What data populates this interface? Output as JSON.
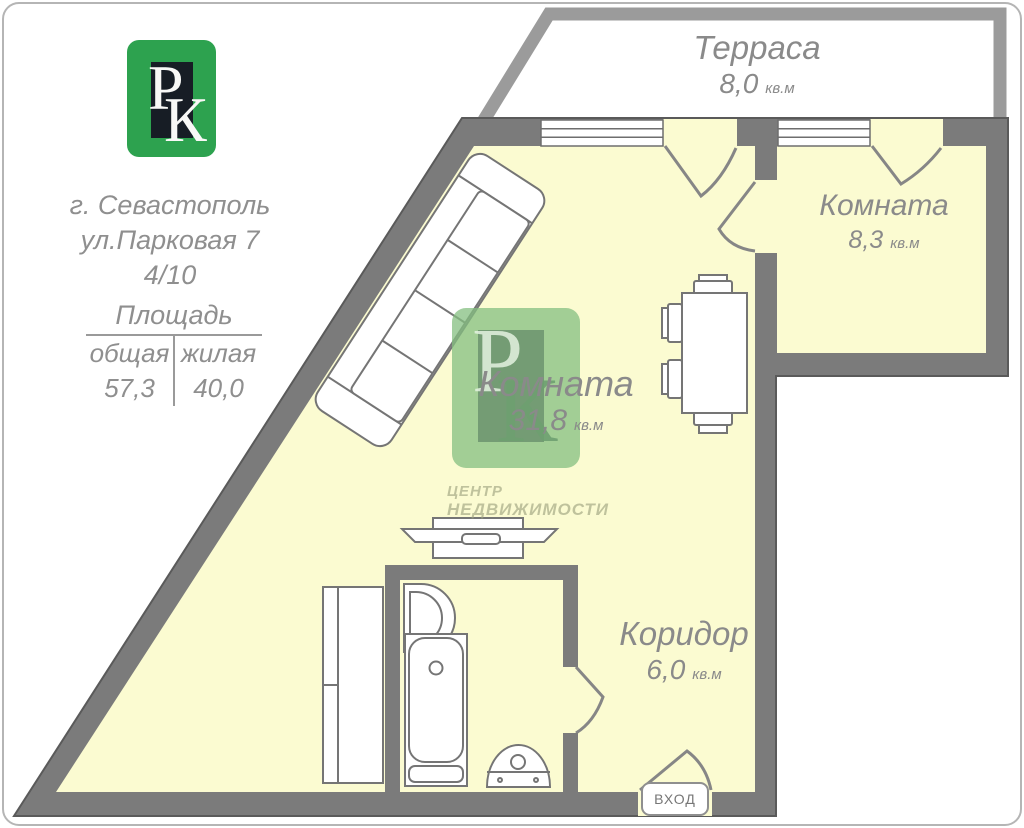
{
  "logo": {
    "p": "Р",
    "k": "К"
  },
  "address": {
    "city": "г. Севастополь",
    "street": "ул.Парковая 7",
    "floors": "4/10"
  },
  "area_table": {
    "title": "Площадь",
    "columns": [
      "общая",
      "жилая"
    ],
    "values": [
      "57,3",
      "40,0"
    ]
  },
  "rooms": {
    "terrace": {
      "name": "Терраса",
      "area": "8,0",
      "unit": "кв.м"
    },
    "room_small": {
      "name": "Комната",
      "area": "8,3",
      "unit": "кв.м"
    },
    "room_main": {
      "name": "Комната",
      "area": "31,8",
      "unit": "кв.м"
    },
    "corridor": {
      "name": "Коридор",
      "area": "6,0",
      "unit": "кв.м"
    }
  },
  "entrance": {
    "label": "ВХОД"
  },
  "watermark": {
    "p": "Р",
    "k": "К",
    "line1": "ЦЕНТР",
    "line2": "НЕДВИЖИМОСТИ"
  },
  "colors": {
    "floor": "#fbfbd1",
    "wall": "#7b7b7b",
    "wall_outline": "#5a5a5a",
    "terrace_wall": "#9b9b9b",
    "furniture_stroke": "#757575",
    "label_text": "#8a8a8a",
    "logo_green": "#2da24f",
    "logo_dark": "#171d25",
    "watermark_green": "#84bf80"
  }
}
